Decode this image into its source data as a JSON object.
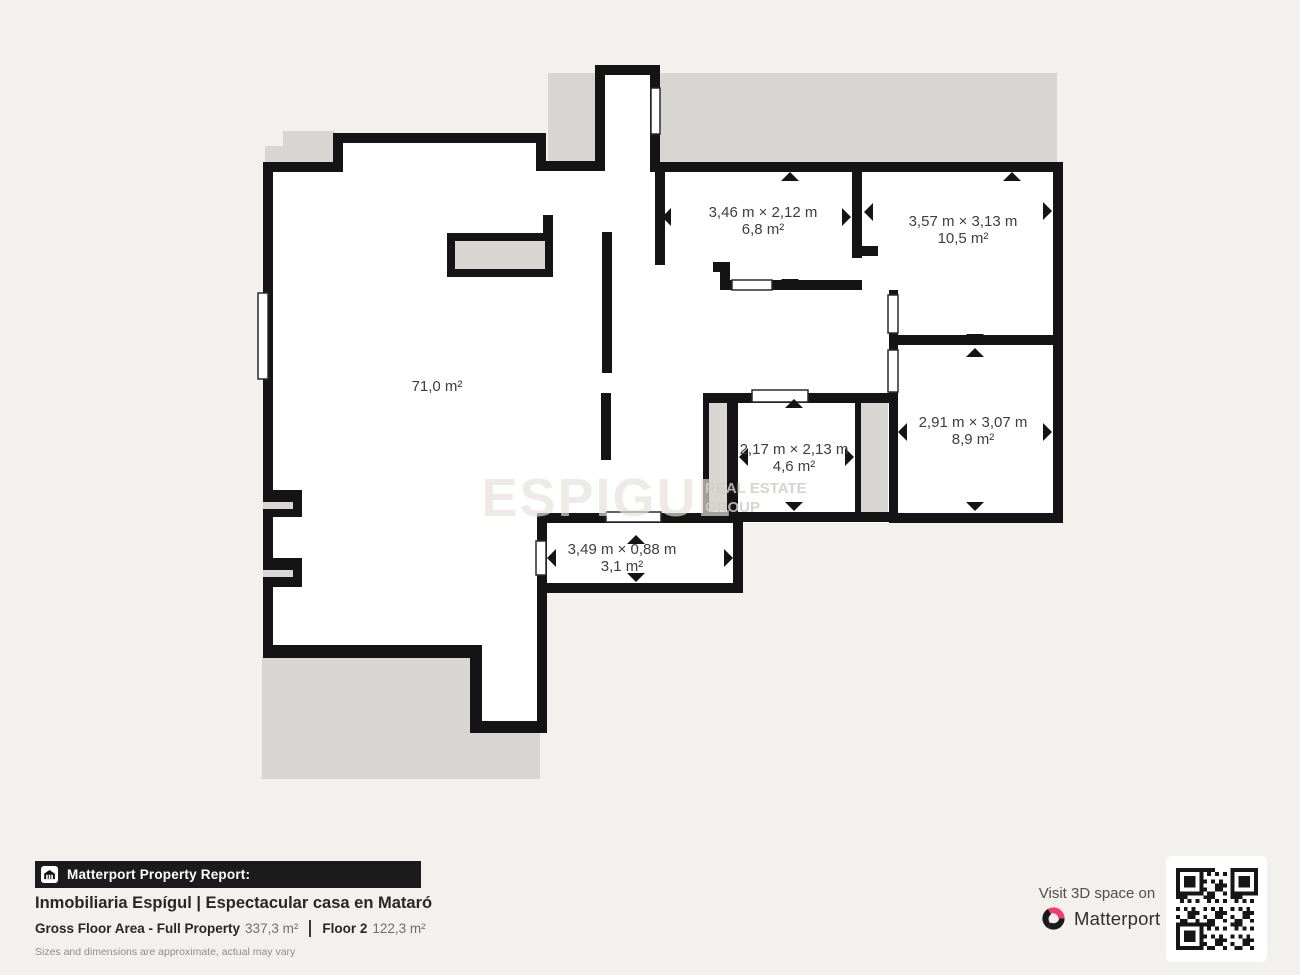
{
  "floorplan": {
    "rooms": [
      {
        "id": "room-6-8",
        "dimensions": "3,46 m × 2,12 m",
        "area": "6,8 m²"
      },
      {
        "id": "room-10-5",
        "dimensions": "3,57 m × 3,13 m",
        "area": "10,5 m²"
      },
      {
        "id": "living-room",
        "dimensions": "",
        "area": "71,0 m²"
      },
      {
        "id": "room-4-6",
        "dimensions": "2,17 m × 2,13 m",
        "area": "4,6 m²"
      },
      {
        "id": "room-8-9",
        "dimensions": "2,91 m × 3,07 m",
        "area": "8,9 m²"
      },
      {
        "id": "corridor",
        "dimensions": "3,49 m × 0,88 m",
        "area": "3,1 m²"
      }
    ],
    "watermark": {
      "brand": "ESPIGUL",
      "line1": "REAL ESTATE",
      "line2": "GROUP"
    }
  },
  "footer": {
    "report_label": "Matterport Property Report:",
    "title": "Inmobiliaria Espígul | Espectacular casa en Mataró",
    "gross_area_label": "Gross Floor Area - Full Property",
    "gross_area_value": "337,3 m²",
    "floor_label": "Floor 2",
    "floor_value": "122,3 m²",
    "disclaimer": "Sizes and dimensions are approximate, actual may vary"
  },
  "cta": {
    "visit_label": "Visit 3D space on",
    "brand": "Matterport"
  },
  "colors": {
    "wall": "#141414",
    "shadow_gray": "#d8d6d3",
    "background": "#f3f1ee",
    "label_text": "#3e3e3e",
    "accent_pink": "#ee3d6e"
  }
}
